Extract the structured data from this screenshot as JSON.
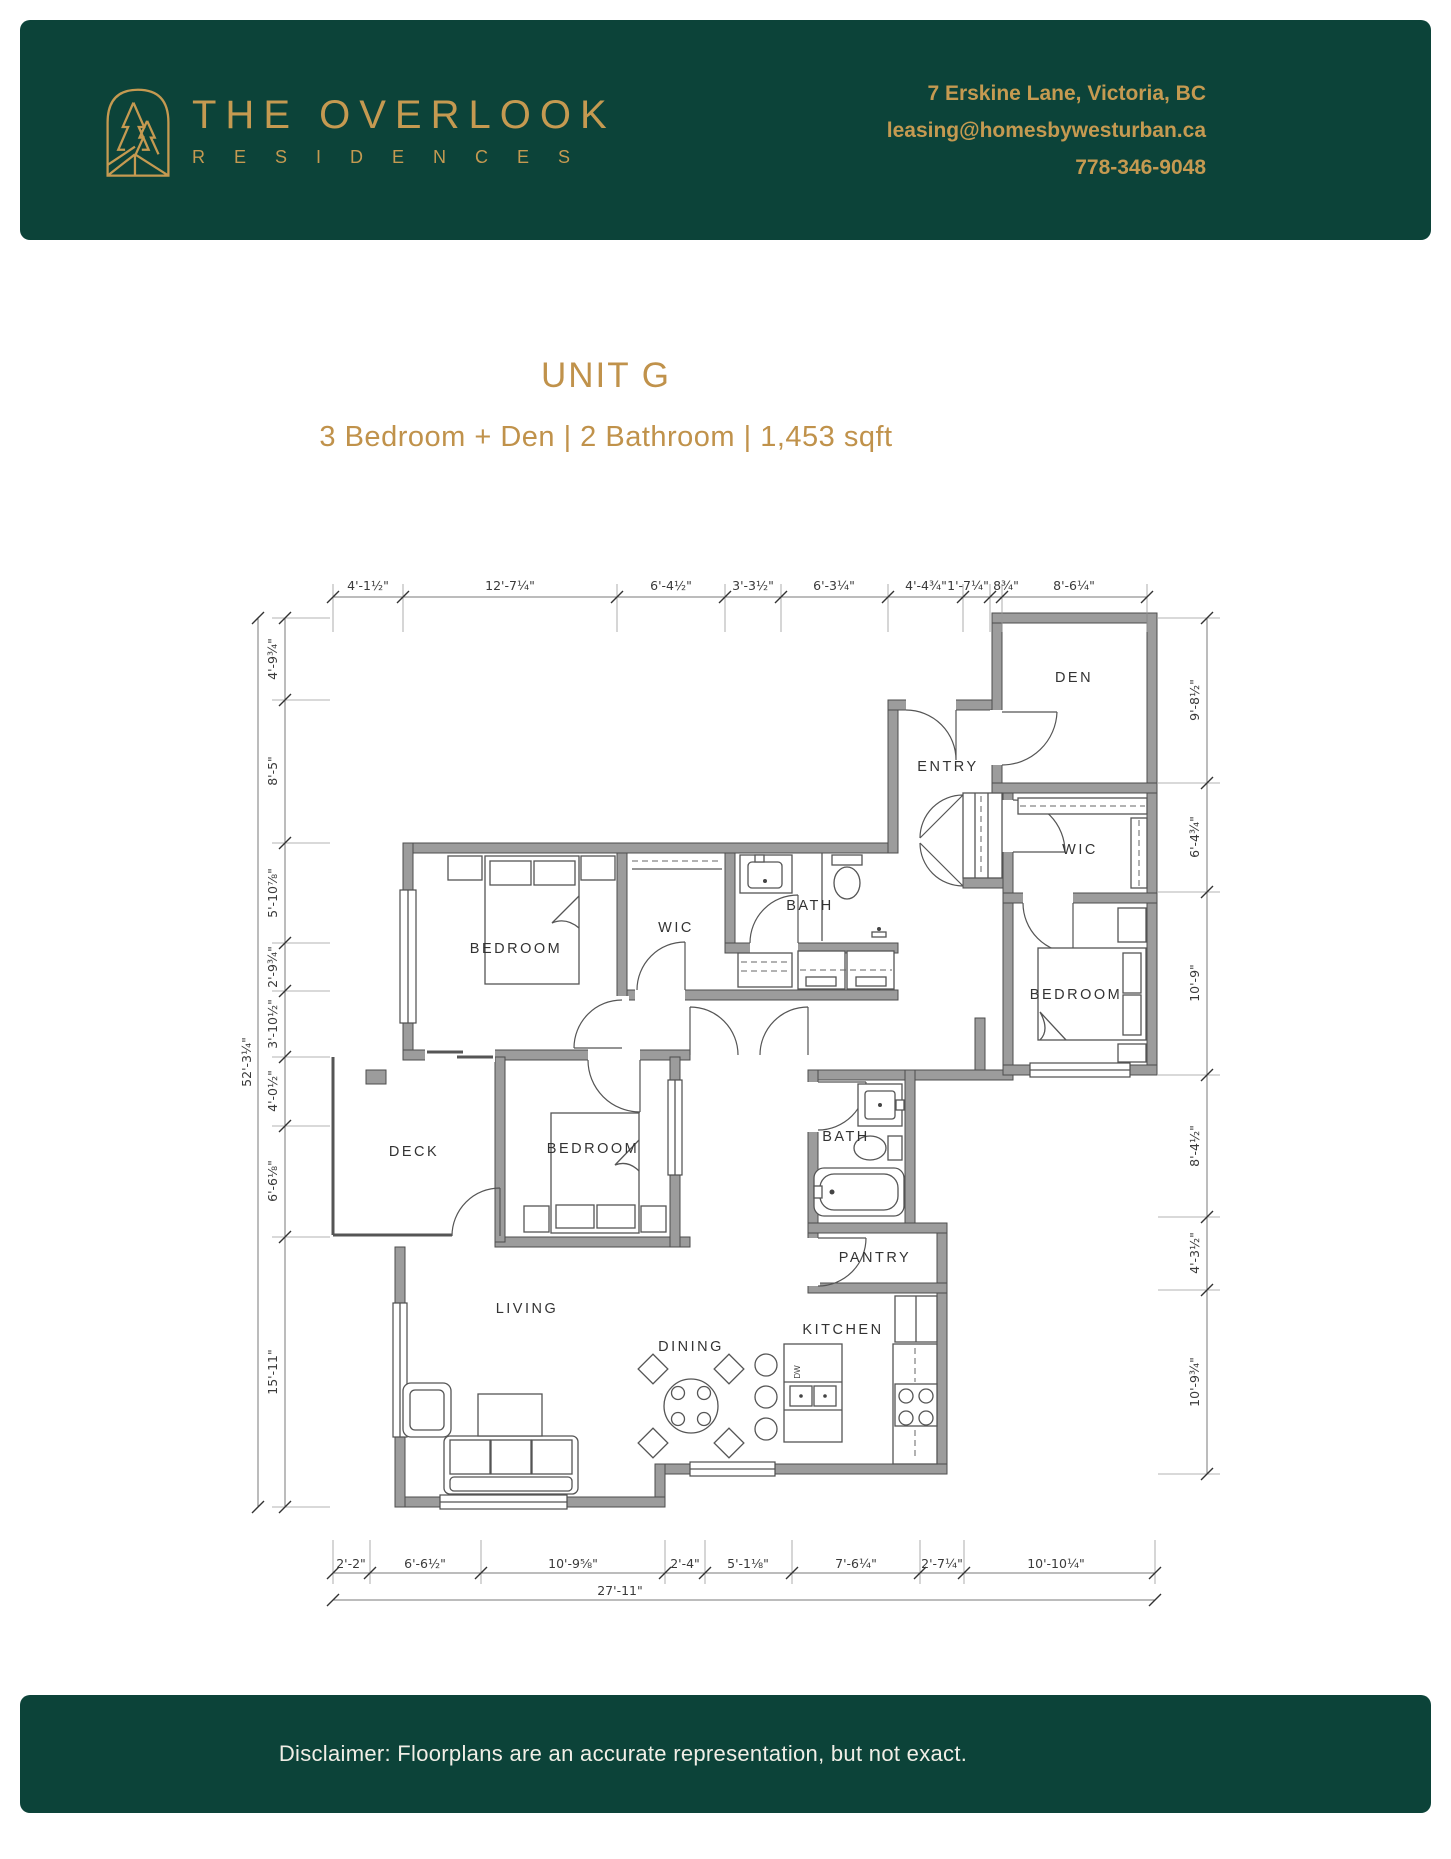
{
  "header": {
    "brand": {
      "line1": "THE OVERLOOK",
      "line2": "R E S I D E N C E S"
    },
    "logo": "arch-pines-logo",
    "contact": {
      "address": "7 Erskine Lane, Victoria, BC",
      "email": "leasing@homesbywesturban.ca",
      "phone": "778-346-9048"
    },
    "colors": {
      "background": "#0c4339",
      "accent": "#c59a51"
    }
  },
  "unit": {
    "title": "UNIT G",
    "subtitle": "3 Bedroom + Den | 2 Bathroom | 1,453 sqft"
  },
  "plan": {
    "rooms": {
      "den": "DEN",
      "entry": "ENTRY",
      "wic_right": "WIC",
      "bath_upper": "BATH",
      "bedroom_upper": "BEDROOM",
      "wic_left": "WIC",
      "bedroom_right": "BEDROOM",
      "deck": "DECK",
      "bedroom_mid": "BEDROOM",
      "bath_lower": "BATH",
      "pantry": "PANTRY",
      "living": "LIVING",
      "dining": "DINING",
      "kitchen": "KITCHEN"
    },
    "appliance_labels": {
      "dishwasher": "DW"
    },
    "dimensions": {
      "top": [
        "4'-1½\"",
        "12'-7¼\"",
        "6'-4½\"",
        "3'-3½\"",
        "6'-3¼\"",
        "4'-4¾\"",
        "1'-7¼\"",
        "8¾\"",
        "8'-6¼\""
      ],
      "left": [
        "4'-9¾\"",
        "8'-5\"",
        "5'-10⅞\"",
        "2'-9¾\"",
        "3'-10½\"",
        "4'-0½\"",
        "6'-6⅛\"",
        "15'-11\""
      ],
      "left_overall": "52'-3¼\"",
      "right": [
        "9'-8½\"",
        "6'-4¾\"",
        "10'-9\"",
        "8'-4½\"",
        "4'-3½\"",
        "10'-9¾\""
      ],
      "bottom": [
        "2'-2\"",
        "6'-6½\"",
        "10'-9⅝\"",
        "2'-4\"",
        "5'-1⅛\"",
        "7'-6¼\"",
        "2'-7¼\"",
        "10'-10¼\""
      ],
      "bottom_overall": "27'-11\""
    }
  },
  "footer": {
    "disclaimer": "Disclaimer: Floorplans are an accurate representation, but not exact."
  }
}
